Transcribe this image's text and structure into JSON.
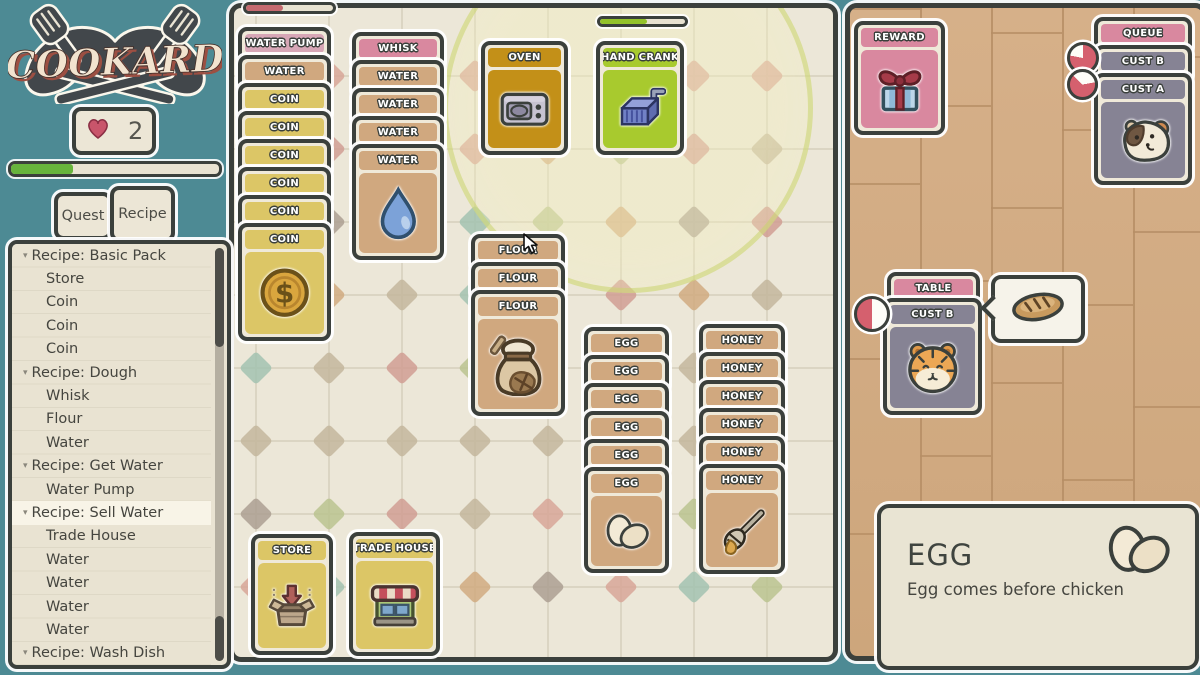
{
  "sidebar": {
    "logo_text": "COOKARD",
    "lives": "2",
    "xp_progress_pct": 30,
    "tabs": [
      {
        "label": "Quest",
        "active": false
      },
      {
        "label": "Recipe",
        "active": true
      }
    ],
    "recipe_list": [
      {
        "label": "Recipe: Basic Pack",
        "header": true
      },
      {
        "label": "Store"
      },
      {
        "label": "Coin"
      },
      {
        "label": "Coin"
      },
      {
        "label": "Coin"
      },
      {
        "label": "Recipe: Dough",
        "header": true
      },
      {
        "label": "Whisk"
      },
      {
        "label": "Flour"
      },
      {
        "label": "Water"
      },
      {
        "label": "Recipe: Get Water",
        "header": true
      },
      {
        "label": "Water Pump"
      },
      {
        "label": "Recipe: Sell Water",
        "header": true,
        "selected": true
      },
      {
        "label": "Trade House"
      },
      {
        "label": "Water"
      },
      {
        "label": "Water"
      },
      {
        "label": "Water"
      },
      {
        "label": "Water"
      },
      {
        "label": "Recipe: Wash Dish",
        "header": true
      }
    ]
  },
  "board": {
    "pump_progress_pct": 42,
    "pump_progress_color": "#c5696f",
    "crank_progress_pct": 55,
    "crank_progress_color": "#93c22a",
    "cursor": {
      "x": 522,
      "y": 233
    },
    "stacks": [
      {
        "name": "water-pump-stack",
        "x": 238,
        "y": 27,
        "w": 93,
        "full_h": 118,
        "cards": [
          {
            "label": "WATER PUMP",
            "type": "pinkLight"
          },
          {
            "label": "WATER",
            "type": "tan"
          },
          {
            "label": "COIN",
            "type": "yellow"
          },
          {
            "label": "COIN",
            "type": "yellow"
          },
          {
            "label": "COIN",
            "type": "yellow"
          },
          {
            "label": "COIN",
            "type": "yellow"
          },
          {
            "label": "COIN",
            "type": "yellow"
          },
          {
            "label": "COIN",
            "type": "yellow",
            "full": true,
            "icon": "coin"
          }
        ]
      },
      {
        "name": "whisk-stack",
        "x": 352,
        "y": 32,
        "w": 92,
        "full_h": 116,
        "cards": [
          {
            "label": "WHISK",
            "type": "pink"
          },
          {
            "label": "WATER",
            "type": "tan"
          },
          {
            "label": "WATER",
            "type": "tan"
          },
          {
            "label": "WATER",
            "type": "tan"
          },
          {
            "label": "WATER",
            "type": "tan",
            "full": true,
            "icon": "droplet"
          }
        ]
      },
      {
        "name": "oven-card",
        "x": 481,
        "y": 41,
        "w": 87,
        "full_h": 114,
        "cards": [
          {
            "label": "OVEN",
            "type": "gold",
            "full": true,
            "icon": "microwave"
          }
        ]
      },
      {
        "name": "hand-crank-card",
        "x": 596,
        "y": 41,
        "w": 88,
        "full_h": 114,
        "cards": [
          {
            "label": "HAND CRANK",
            "type": "green",
            "full": true,
            "icon": "crank"
          }
        ]
      },
      {
        "name": "flour-stack",
        "x": 471,
        "y": 234,
        "w": 94,
        "full_h": 126,
        "cards": [
          {
            "label": "FLOUR",
            "type": "tan"
          },
          {
            "label": "FLOUR",
            "type": "tan"
          },
          {
            "label": "FLOUR",
            "type": "tan",
            "full": true,
            "icon": "floursack"
          }
        ]
      },
      {
        "name": "egg-stack",
        "x": 584,
        "y": 327,
        "w": 85,
        "full_h": 106,
        "cards": [
          {
            "label": "EGG",
            "type": "tan"
          },
          {
            "label": "EGG",
            "type": "tan"
          },
          {
            "label": "EGG",
            "type": "tan"
          },
          {
            "label": "EGG",
            "type": "tan"
          },
          {
            "label": "EGG",
            "type": "tan"
          },
          {
            "label": "EGG",
            "type": "tan",
            "full": true,
            "icon": "eggs"
          }
        ]
      },
      {
        "name": "honey-stack",
        "x": 699,
        "y": 324,
        "w": 86,
        "full_h": 110,
        "cards": [
          {
            "label": "HONEY",
            "type": "tan"
          },
          {
            "label": "HONEY",
            "type": "tan"
          },
          {
            "label": "HONEY",
            "type": "tan"
          },
          {
            "label": "HONEY",
            "type": "tan"
          },
          {
            "label": "HONEY",
            "type": "tan"
          },
          {
            "label": "HONEY",
            "type": "tan",
            "full": true,
            "icon": "honey"
          }
        ]
      },
      {
        "name": "store-card",
        "x": 251,
        "y": 534,
        "w": 82,
        "full_h": 121,
        "cards": [
          {
            "label": "STORE",
            "type": "yellow",
            "full": true,
            "icon": "storebox"
          }
        ]
      },
      {
        "name": "trade-house-card",
        "x": 349,
        "y": 532,
        "w": 91,
        "full_h": 124,
        "cards": [
          {
            "label": "TRADE HOUSE",
            "type": "yellow",
            "full": true,
            "icon": "shop"
          }
        ]
      }
    ]
  },
  "right": {
    "stacks": [
      {
        "name": "reward-card",
        "x": 854,
        "y": 21,
        "w": 91,
        "full_h": 114,
        "cards": [
          {
            "label": "REWARD",
            "type": "pink",
            "full": true,
            "icon": "gift"
          }
        ]
      },
      {
        "name": "queue-stack",
        "x": 1094,
        "y": 17,
        "w": 98,
        "full_h": 112,
        "cards": [
          {
            "label": "QUEUE",
            "type": "pink"
          },
          {
            "label": "CUST B",
            "type": "gray"
          },
          {
            "label": "CUST A",
            "type": "gray",
            "full": true,
            "icon": "guineapig"
          }
        ]
      },
      {
        "name": "table-card",
        "x": 887,
        "y": 272,
        "w": 93,
        "full_h": 34,
        "cards": [
          {
            "label": "TABLE",
            "type": "pink"
          }
        ]
      },
      {
        "name": "table-customer-card",
        "x": 883,
        "y": 298,
        "w": 99,
        "full_h": 117,
        "cards": [
          {
            "label": "CUST B",
            "type": "gray",
            "full": true,
            "icon": "tiger"
          }
        ]
      }
    ],
    "timers": [
      {
        "x": 1067,
        "y": 42,
        "d": 26,
        "pct": 78,
        "start_deg": 0,
        "color": "#d5606e"
      },
      {
        "x": 1067,
        "y": 69,
        "d": 25,
        "pct": 65,
        "start_deg": 80,
        "color": "#d5606e"
      },
      {
        "x": 854,
        "y": 296,
        "d": 30,
        "pct": 50,
        "start_deg": 180,
        "color": "#d5606e"
      }
    ],
    "order_bubble": {
      "x": 991,
      "y": 275,
      "w": 86,
      "h": 60,
      "item": "bread"
    }
  },
  "info_panel": {
    "x": 877,
    "y": 504,
    "w": 314,
    "h": 158,
    "title": "EGG",
    "description": "Egg comes before chicken",
    "icon": "eggs"
  }
}
